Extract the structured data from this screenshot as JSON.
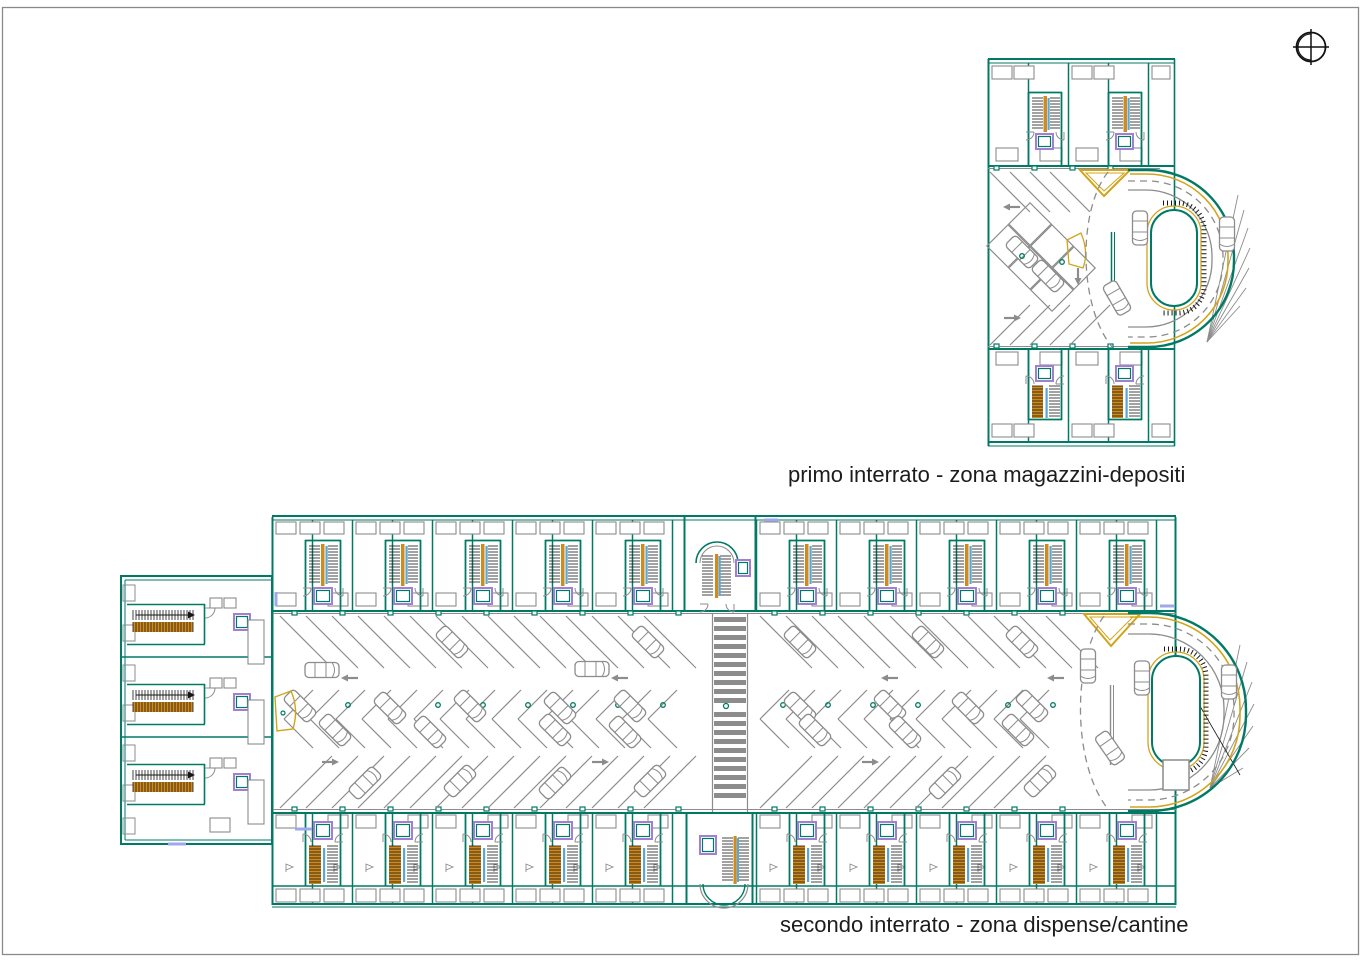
{
  "sheet": {
    "background": "#ffffff",
    "border_gray": "#8a8a8a"
  },
  "captions": {
    "primo": "primo interrato - zona magazzini-depositi",
    "secondo": "secondo interrato - zona dispense/cantine"
  },
  "plans": [
    {
      "id": "primo-interrato",
      "caption": "primo interrato - zona magazzini-depositi"
    },
    {
      "id": "secondo-interrato",
      "caption": "secondo interrato - zona dispense/cantine"
    }
  ],
  "icons": {
    "north_indicator": "compass-crosshair-icon",
    "stairs": "staircase-glyph",
    "elevator": "elevator-glyph",
    "car": "car-icon",
    "arrow": "direction-arrow-icon"
  },
  "colors": {
    "wall_teal": "#007a64",
    "ramp_gold": "#d2a41c",
    "stair_orange": "#d08a1e",
    "detail_gray": "#8c8c8c",
    "elevator_purple": "#a07fd4",
    "stair_blue": "#5aa7d4",
    "lavender_accent": "#9fa8e8",
    "hatch_black": "#161616",
    "text_color": "#1c1c1c"
  }
}
